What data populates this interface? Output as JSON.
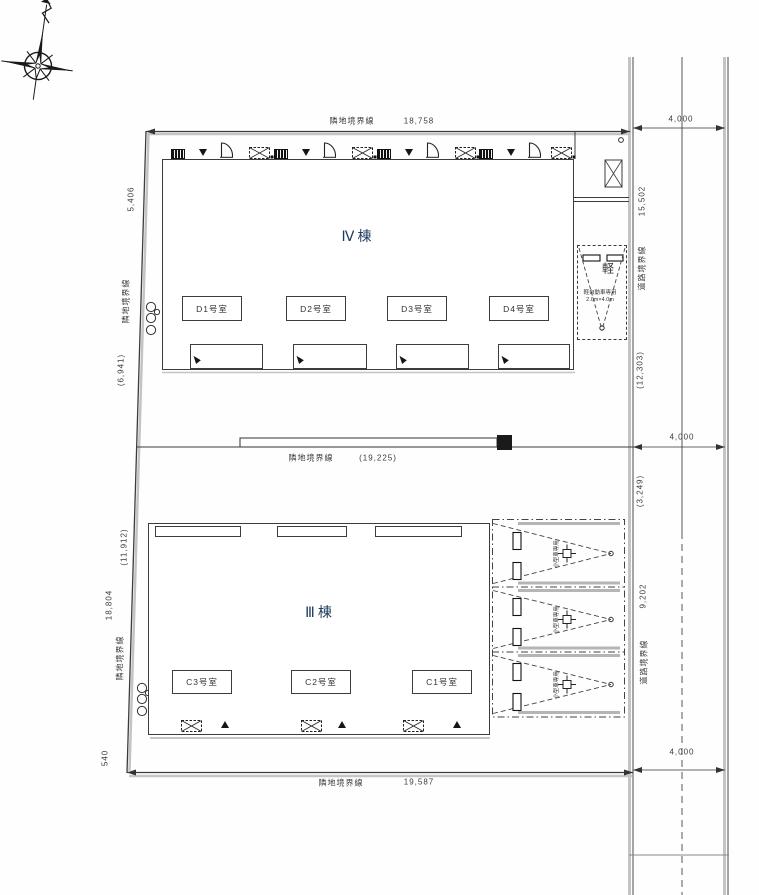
{
  "boundaries": {
    "top": {
      "label": "隣地境界線",
      "value": "18,758"
    },
    "middle": {
      "label": "隣地境界線",
      "value": "(19,225)"
    },
    "bottom": {
      "label": "隣地境界線",
      "value": "19,587"
    }
  },
  "left_labels": [
    "5,406",
    "隣地境界線",
    "(6,941)",
    "(11,912)",
    "18,804",
    "隣地境界線",
    "540"
  ],
  "right_labels": [
    "15,502",
    "道路境界線",
    "(12,303)",
    "(3,249)",
    "9,202",
    "道路境界線"
  ],
  "road": {
    "width_top": "4,000",
    "width_middle": "4,000",
    "width_bottom": "4,000"
  },
  "buildings": {
    "iv": {
      "name": "Ⅳ棟",
      "rooms": [
        "D1号室",
        "D2号室",
        "D3号室",
        "D4号室"
      ]
    },
    "iii": {
      "name": "Ⅲ棟",
      "rooms": [
        "C3号室",
        "C2号室",
        "C1号室"
      ]
    }
  },
  "parking": {
    "kei": {
      "label": "軽",
      "note1": "軽自動車専用",
      "note2": "2.0m×4.0m"
    },
    "compact": [
      "小型車専用",
      "小型車専用",
      "小型車専用"
    ]
  },
  "colors": {
    "line": "#3c3c3c",
    "shadow": "#c4c4c4",
    "label_blue": "#1d3a5f"
  }
}
